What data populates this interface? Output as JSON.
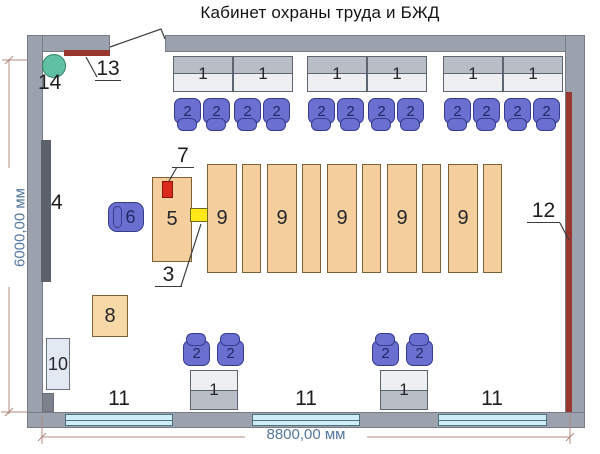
{
  "title": "Кабинет охраны труда и БЖД",
  "dimension_labels": {
    "bottom": "8800,00 мм",
    "left": "6000,00 мм"
  },
  "item_labels": {
    "desk": "1",
    "chair": "2",
    "item3": "3",
    "board": "4",
    "teacher_desk": "5",
    "teacher_chair": "6",
    "item7": "7",
    "item8": "8",
    "lab_table": "9",
    "item10": "10",
    "window": "11",
    "item12": "12",
    "item13": "13",
    "item14": "14"
  },
  "colors": {
    "wall": "#9ba1ad",
    "wall_dark": "#7c818c",
    "board": "#5d616b",
    "desk_gray": "#b9bdc5",
    "desk_light": "#edeff3",
    "desk_border": "#5f6570",
    "chair": "#6b70d0",
    "chair_border": "#373b8e",
    "chair_num": "#1f2a66",
    "table": "#f4cf9d",
    "table_border": "#7c6236",
    "red_item": "#da291d",
    "yellow_item": "#ffe718",
    "teal_item": "#5fc0a4",
    "red_strip": "#99372f",
    "window": "#cdeef7",
    "window_border": "#50707f",
    "cabinet_light": "#e3e9f3",
    "dim_text": "#54779e",
    "dim_line": "#b5897d",
    "label": "#1e1e1e"
  }
}
